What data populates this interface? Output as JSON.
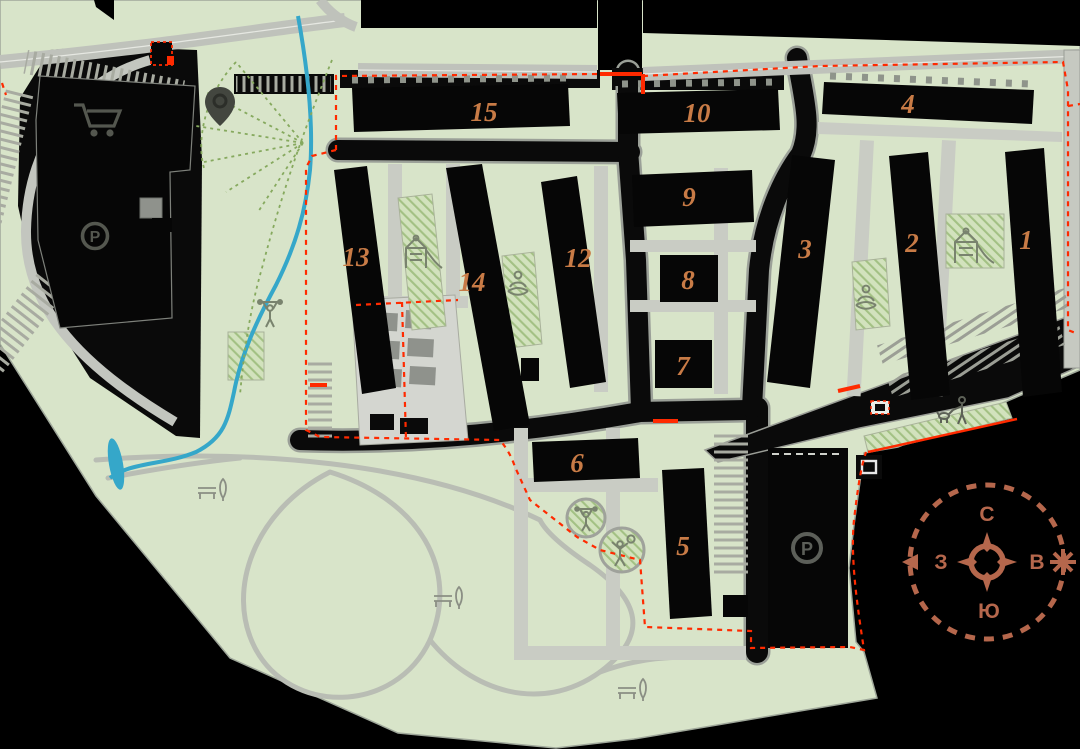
{
  "scene": {
    "type": "residential-complex-master-plan",
    "background": "#000000"
  },
  "palette": {
    "land": "#d8e4c9",
    "walkway_gray": "#c6c9c1",
    "street_black": "#0a0a0a",
    "building_black": "#060606",
    "boundary_red": "#ff2a00",
    "number_orange": "#c87b46",
    "compass_terracotta": "#b5674c",
    "water_blue": "#35a7c9",
    "hatch_green": "#a3c184",
    "icon_gray": "#545750",
    "icon_green": "#79836e"
  },
  "buildings": {
    "1": {
      "label": "1"
    },
    "2": {
      "label": "2"
    },
    "3": {
      "label": "3"
    },
    "4": {
      "label": "4"
    },
    "5": {
      "label": "5"
    },
    "6": {
      "label": "6"
    },
    "7": {
      "label": "7"
    },
    "8": {
      "label": "8"
    },
    "9": {
      "label": "9"
    },
    "10": {
      "label": "10"
    },
    "12": {
      "label": "12"
    },
    "13": {
      "label": "13"
    },
    "14": {
      "label": "14"
    },
    "15": {
      "label": "15"
    }
  },
  "parking": {
    "symbol": "P"
  },
  "compass": {
    "north": "С",
    "east": "В",
    "south": "Ю",
    "west": "З"
  },
  "amenities": [
    "shopping-cart-icon",
    "location-pin-icon",
    "parking-icon",
    "playground-icon",
    "yoga-icon",
    "workout-icon",
    "ball-court-icon",
    "bench-icon",
    "tree-icon",
    "dog-walking-icon",
    "substation-icon",
    "compass-rose",
    "sun-icon"
  ]
}
